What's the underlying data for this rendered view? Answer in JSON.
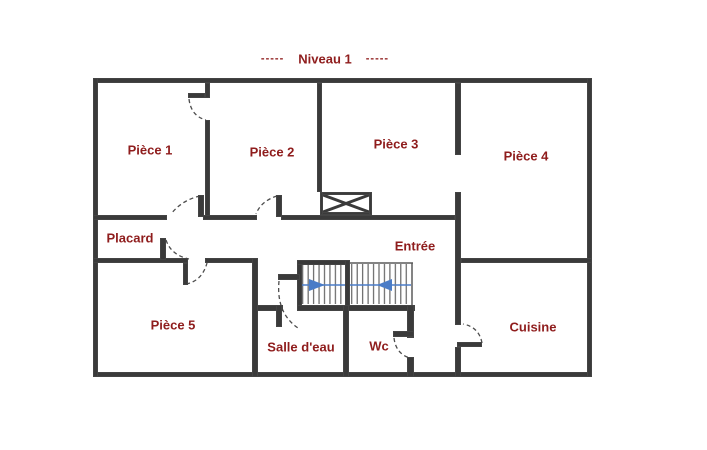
{
  "title": {
    "dashes_left": "-----",
    "text": "Niveau 1",
    "dashes_right": "-----"
  },
  "rooms": [
    {
      "id": "piece-1",
      "name": "Pièce 1"
    },
    {
      "id": "piece-2",
      "name": "Pièce 2"
    },
    {
      "id": "piece-3",
      "name": "Pièce 3"
    },
    {
      "id": "piece-4",
      "name": "Pièce 4"
    },
    {
      "id": "piece-5",
      "name": "Pièce 5"
    },
    {
      "id": "placard",
      "name": "Placard"
    },
    {
      "id": "entree",
      "name": "Entrée"
    },
    {
      "id": "salle-d-eau",
      "name": "Salle d'eau"
    },
    {
      "id": "wc",
      "name": "Wc"
    },
    {
      "id": "cuisine",
      "name": "Cuisine"
    }
  ],
  "colors": {
    "room_label": "#8f1d1d",
    "wall": "#3a3a3a",
    "stair_arrow": "#4a7cc7",
    "door_arc": "#4d4d4d"
  }
}
